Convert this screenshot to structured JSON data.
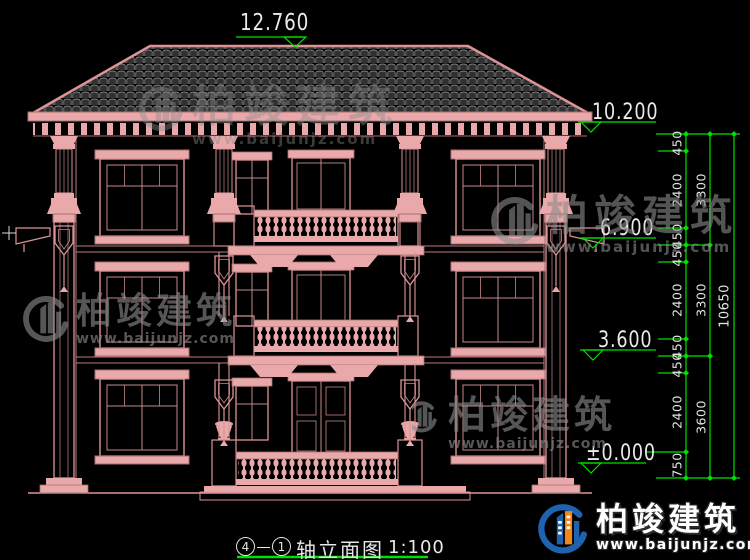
{
  "drawing": {
    "top_elevation": "12.760",
    "elevations": [
      "10.200",
      "6.900",
      "3.600",
      "±0.000"
    ],
    "dim_chain_inner": [
      "450",
      "2400",
      "450",
      "450",
      "2400",
      "450",
      "450",
      "2400",
      "750"
    ],
    "dim_chain_floor": [
      "3300",
      "3300",
      "3600"
    ],
    "dim_chain_total": [
      "10650"
    ]
  },
  "title_block": {
    "axis_start": "4",
    "axis_end": "1",
    "label": "轴立面图",
    "scale": "1:100"
  },
  "brand": {
    "name": "柏竣建筑",
    "url": "www.baijunjz.com"
  },
  "icons": {
    "logo": "building-logo"
  },
  "colors": {
    "background": "#000000",
    "line_pink": "#DE9496",
    "fill_pink": "#E9A9AB",
    "dim_green": "#00E000",
    "text_white": "#EAEAEA",
    "watermark_gray": "#8C8C8C",
    "logo_blue": "#1E62B0",
    "logo_orange": "#F08519"
  }
}
